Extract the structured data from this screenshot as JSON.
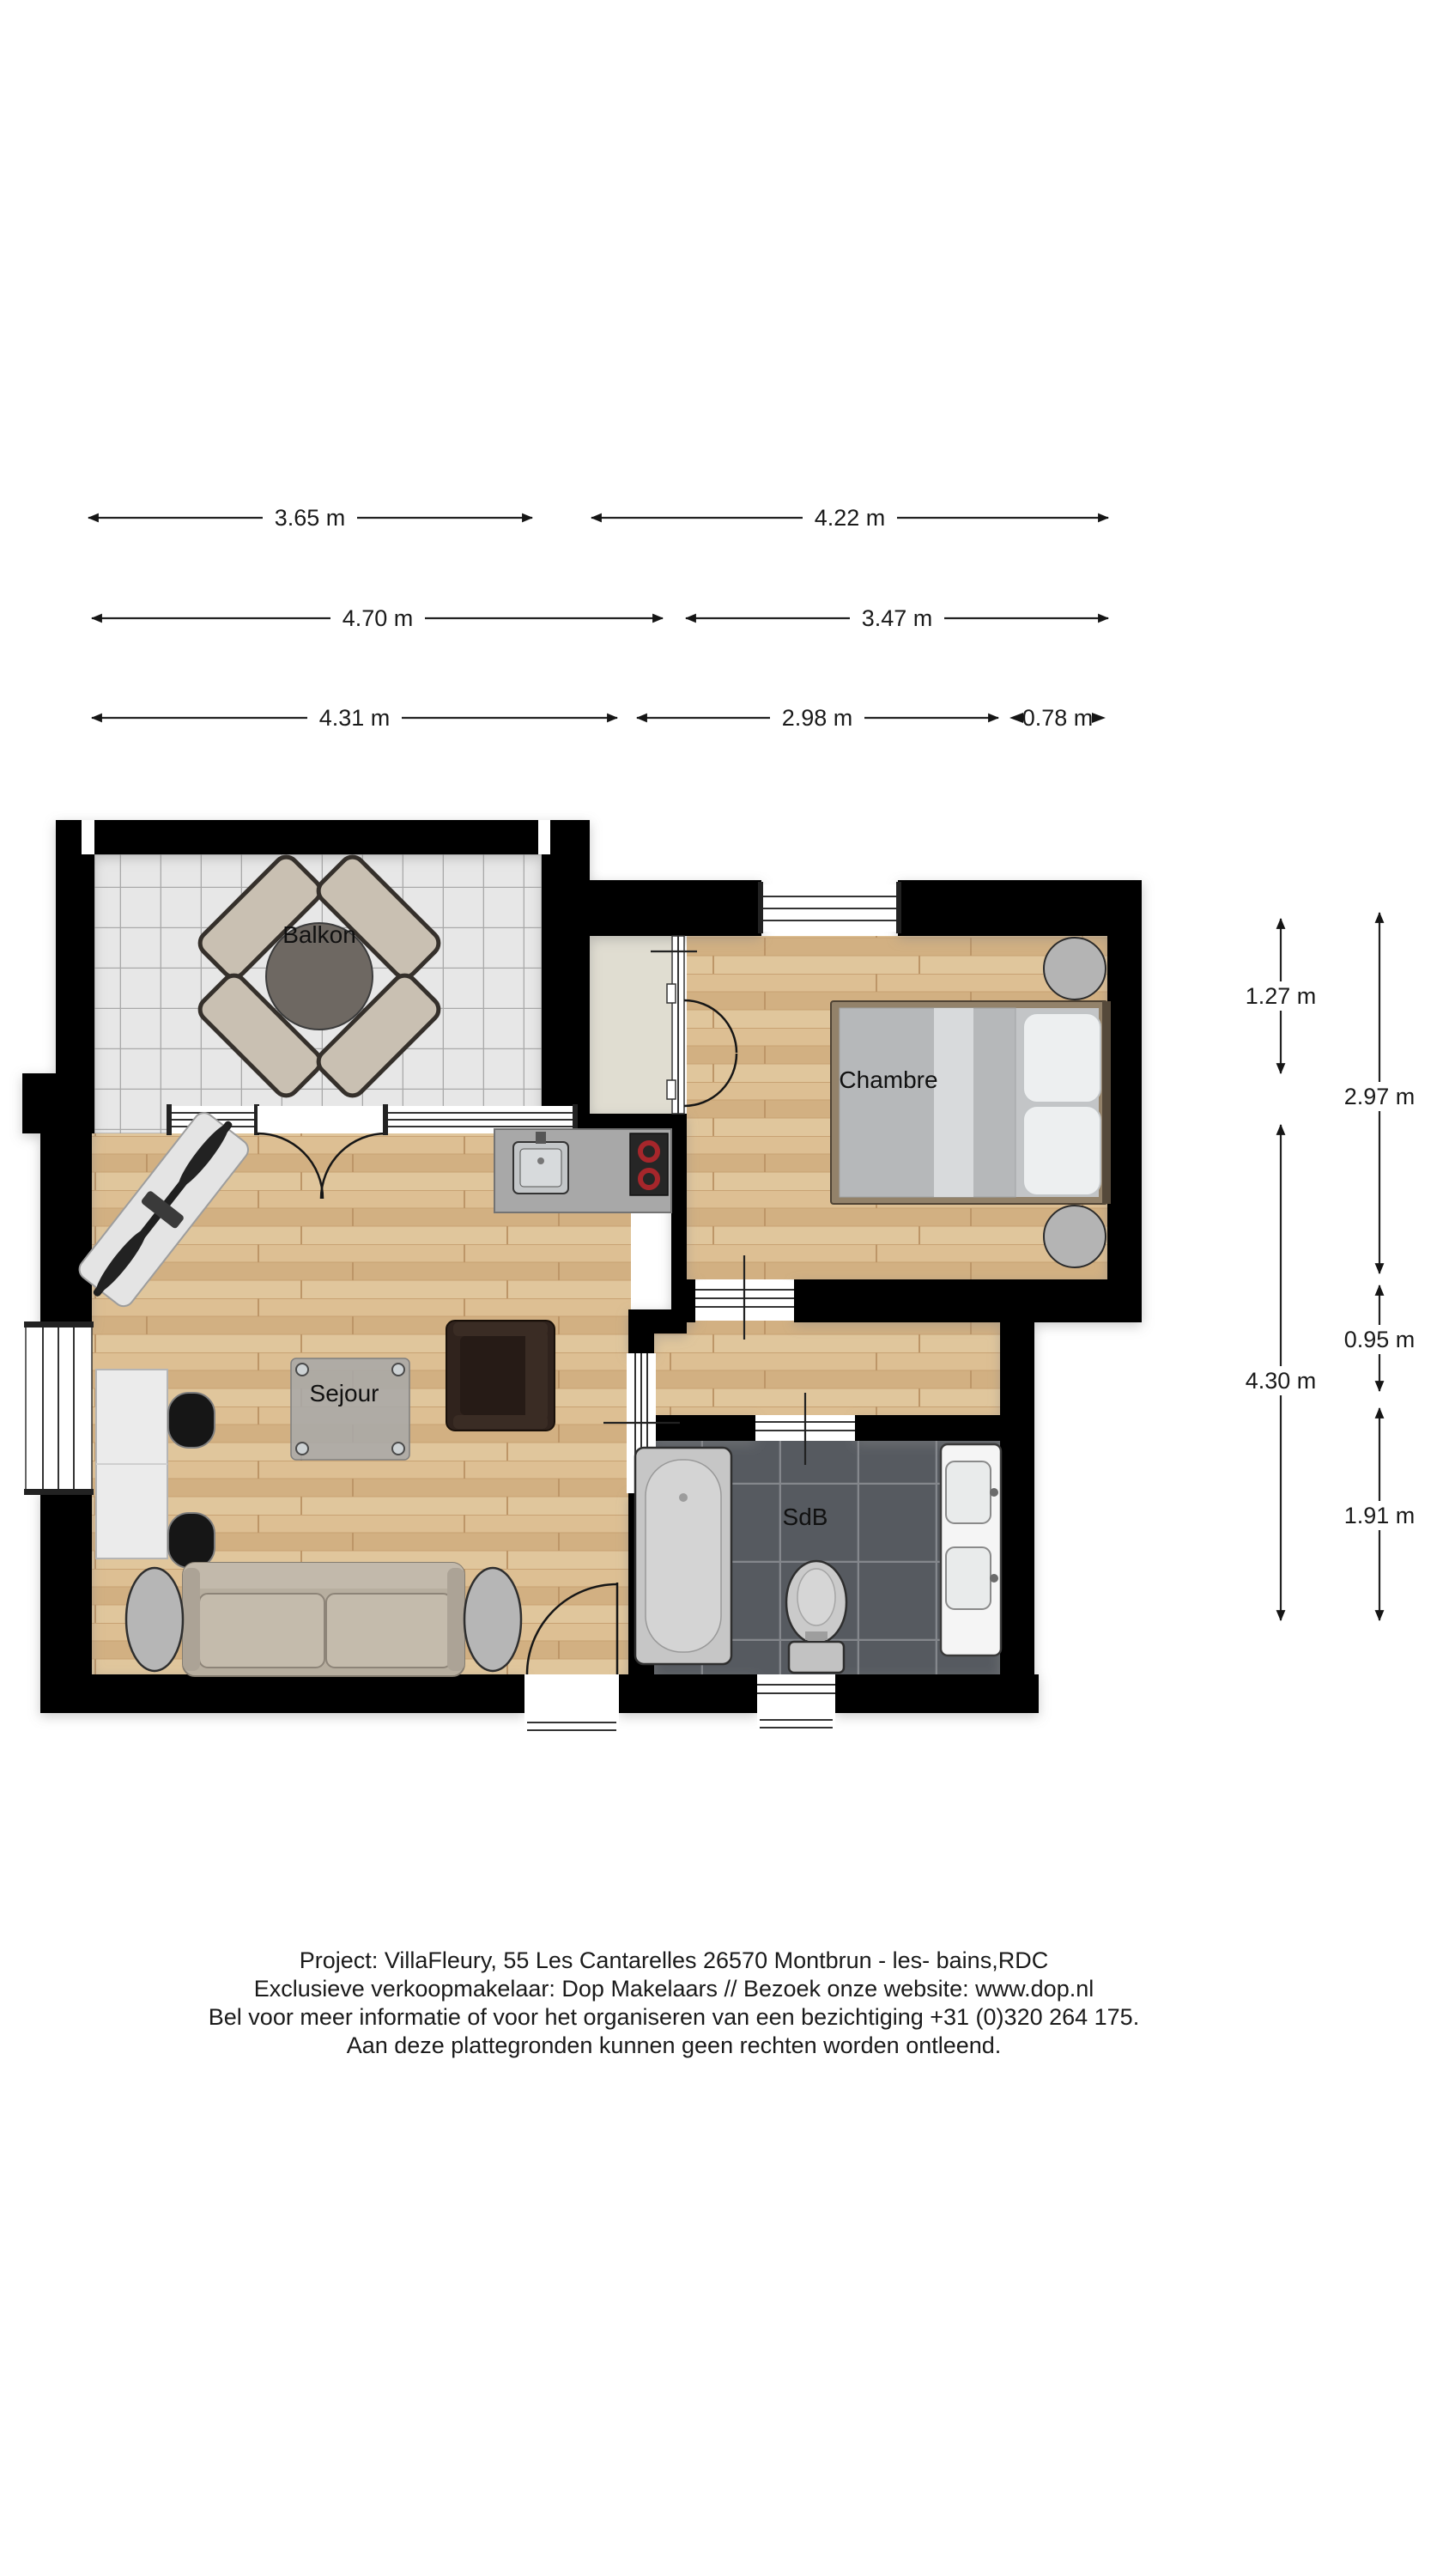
{
  "plan": {
    "rooms": {
      "balkon": "Balkon",
      "chambre": "Chambre",
      "sejour": "Sejour",
      "sdb": "SdB"
    }
  },
  "dimensions": {
    "horizontal_row1": [
      {
        "label": "3.65 m"
      },
      {
        "label": "4.22 m"
      }
    ],
    "horizontal_row2": [
      {
        "label": "4.70 m"
      },
      {
        "label": "3.47 m"
      }
    ],
    "horizontal_row3": [
      {
        "label": "4.31 m"
      },
      {
        "label": "2.98 m"
      },
      {
        "label": "0.78 m"
      }
    ],
    "vertical_inner": [
      {
        "label": "1.27 m"
      },
      {
        "label": "4.30 m"
      }
    ],
    "vertical_outer": [
      {
        "label": "2.97 m"
      },
      {
        "label": "0.95 m"
      },
      {
        "label": "1.91 m"
      }
    ]
  },
  "footer": {
    "lines": [
      "Project: VillaFleury, 55 Les Cantarelles 26570 Montbrun - les- bains,RDC",
      "Exclusieve verkoopmakelaar: Dop Makelaars // Bezoek onze website: www.dop.nl",
      "Bel voor meer informatie of voor het organiseren van een bezichtiging +31 (0)320 264 175.",
      "Aan deze plattegronden kunnen geen rechten worden ontleend."
    ]
  },
  "colors": {
    "wall": "#050505",
    "wood_floor": "#d9b98c",
    "balcony_tile": "#e7e7e7",
    "bathroom_tile": "#565a60",
    "closet_floor": "#e0ddd1",
    "burner_red": "#a6262b"
  }
}
